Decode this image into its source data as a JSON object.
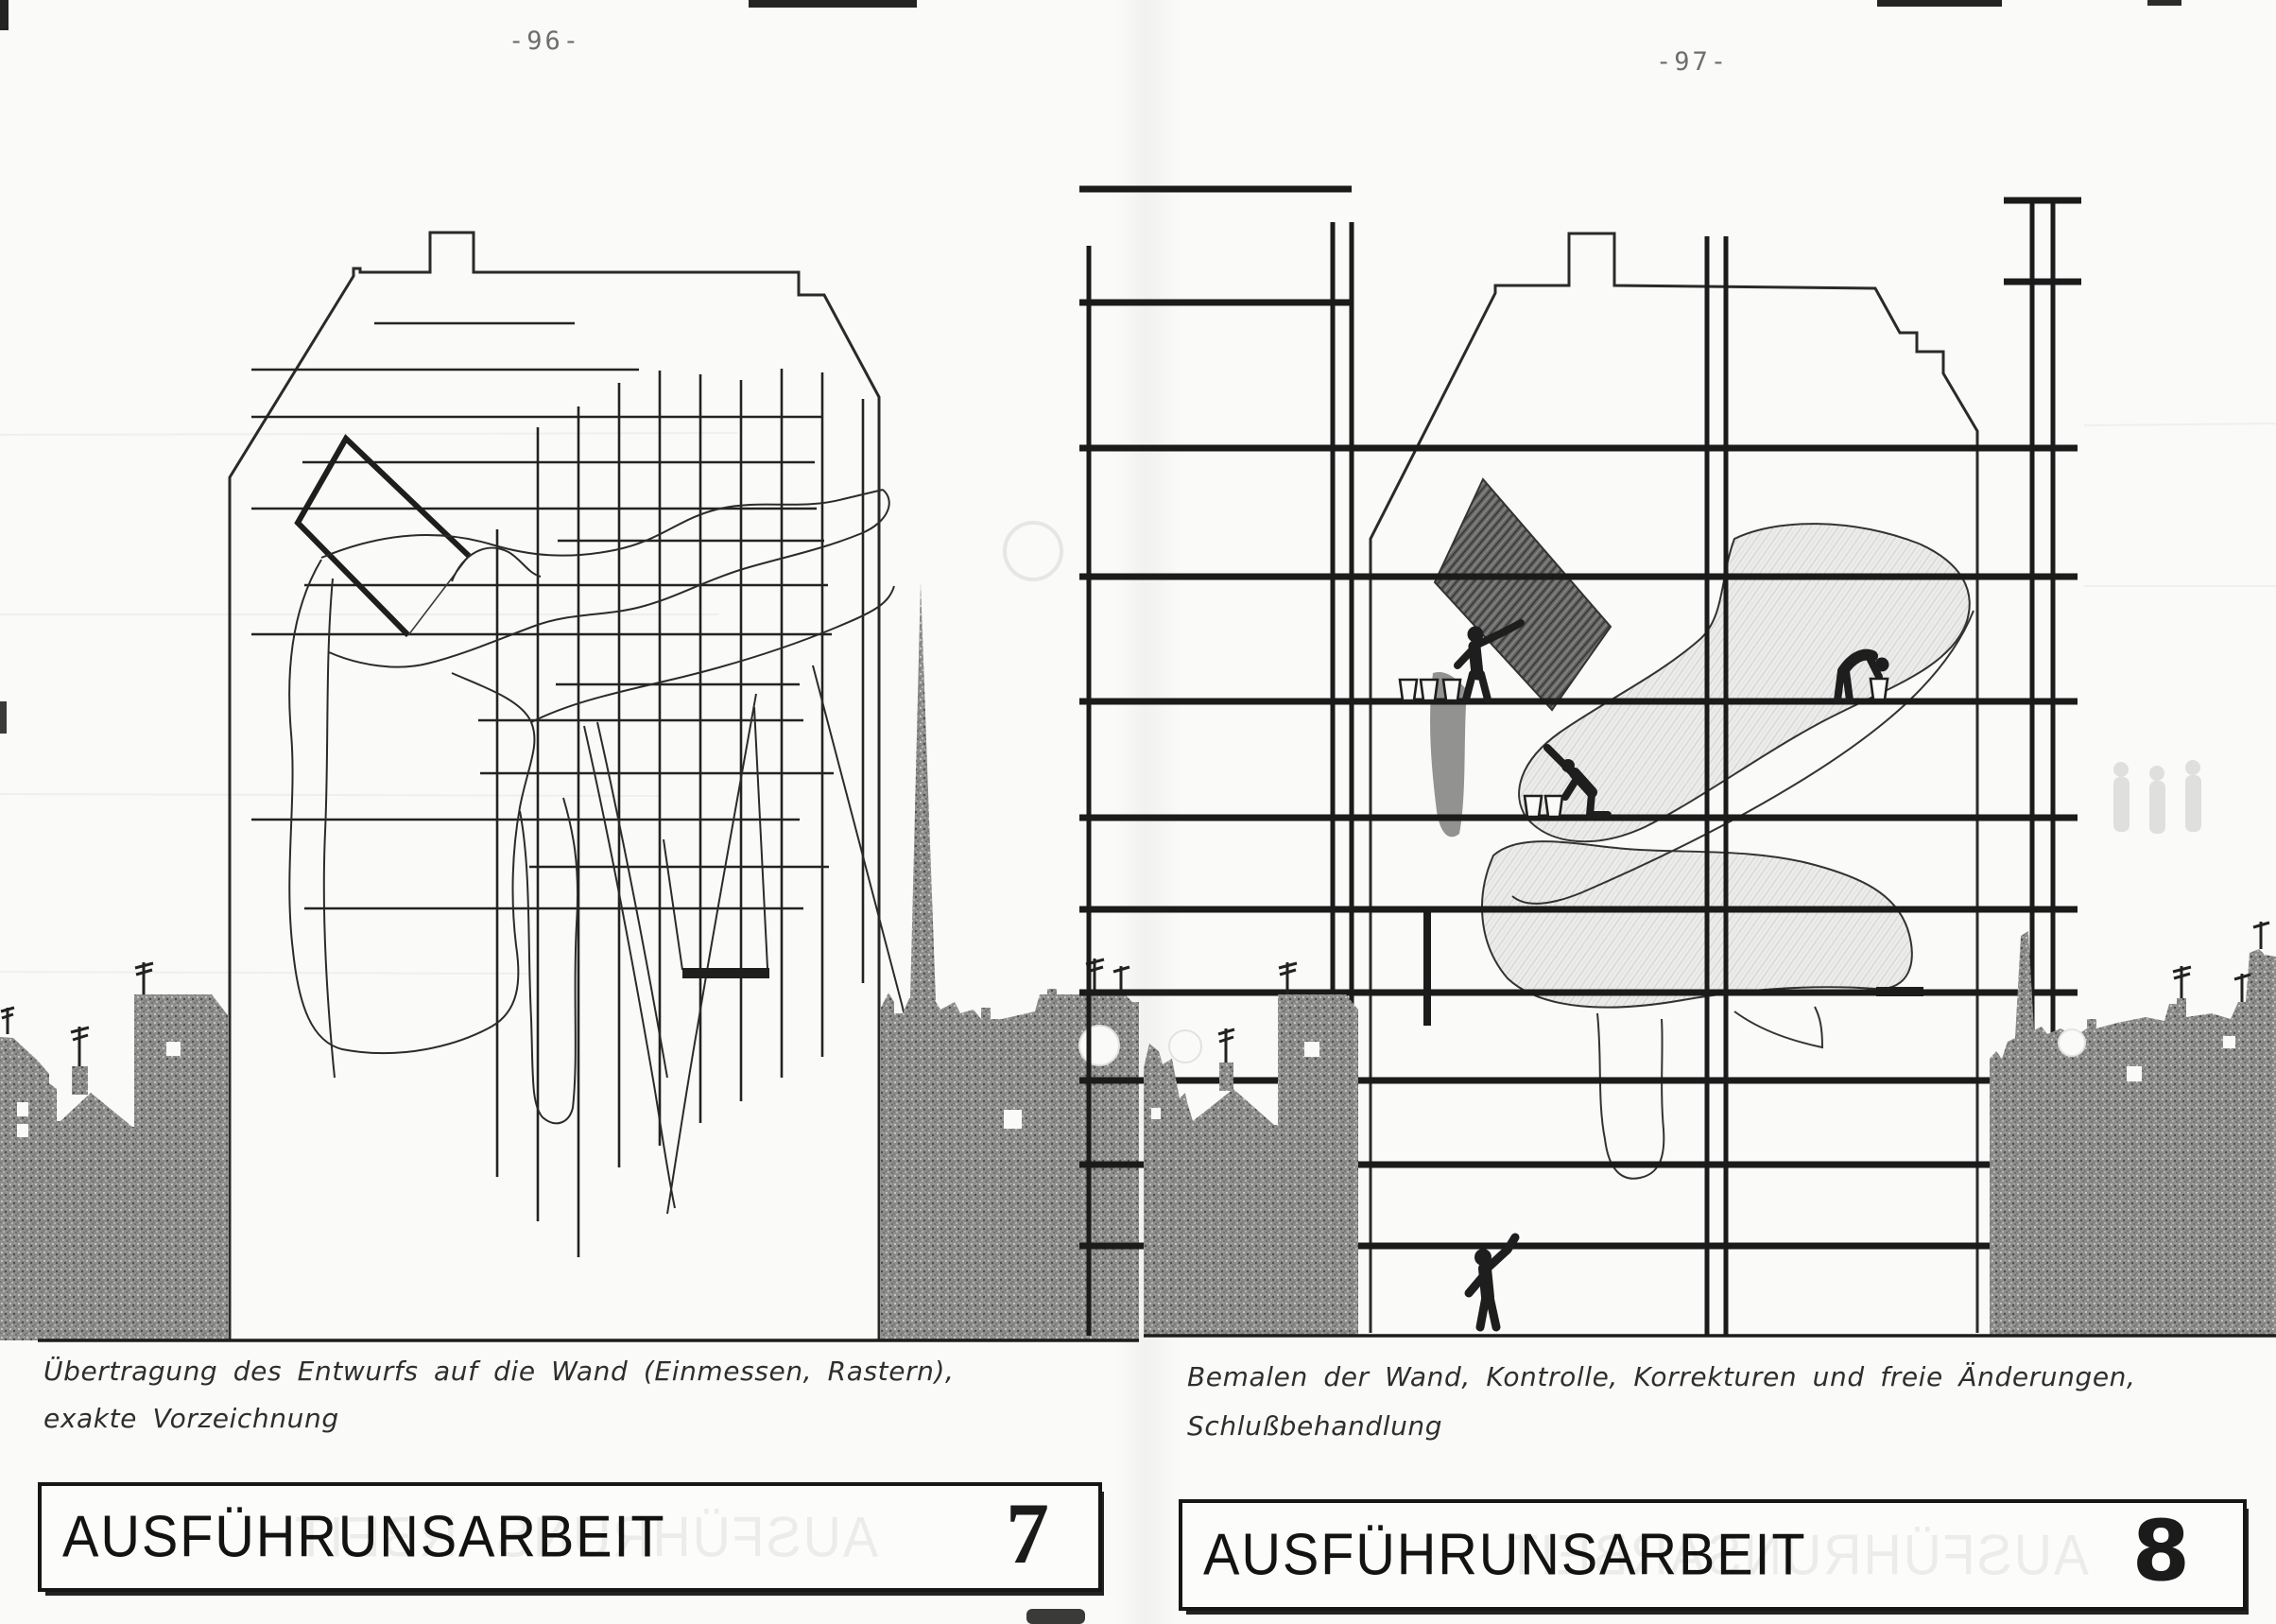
{
  "pages": {
    "left": {
      "page_number": "-96-",
      "caption": [
        "Übertragung des Entwurfs auf die Wand (Einmessen, Rastern),",
        "exakte Vorzeichnung"
      ],
      "title": "AUSFÜHRUNSARBEIT",
      "title_number": "7"
    },
    "right": {
      "page_number": "-97-",
      "caption": [
        "Bemalen der Wand, Kontrolle, Korrekturen und freie Änderungen,",
        "Schlußbehandlung"
      ],
      "title": "AUSFÜHRUNSARBEIT",
      "title_number": "8"
    }
  },
  "colors": {
    "paper": "#fafaf8",
    "ink": "#1c1c1c",
    "silhouette_gray": "#8d8d8b",
    "shade_gray": "#ededeb",
    "dark_shape_gray": "#6a6a68"
  }
}
